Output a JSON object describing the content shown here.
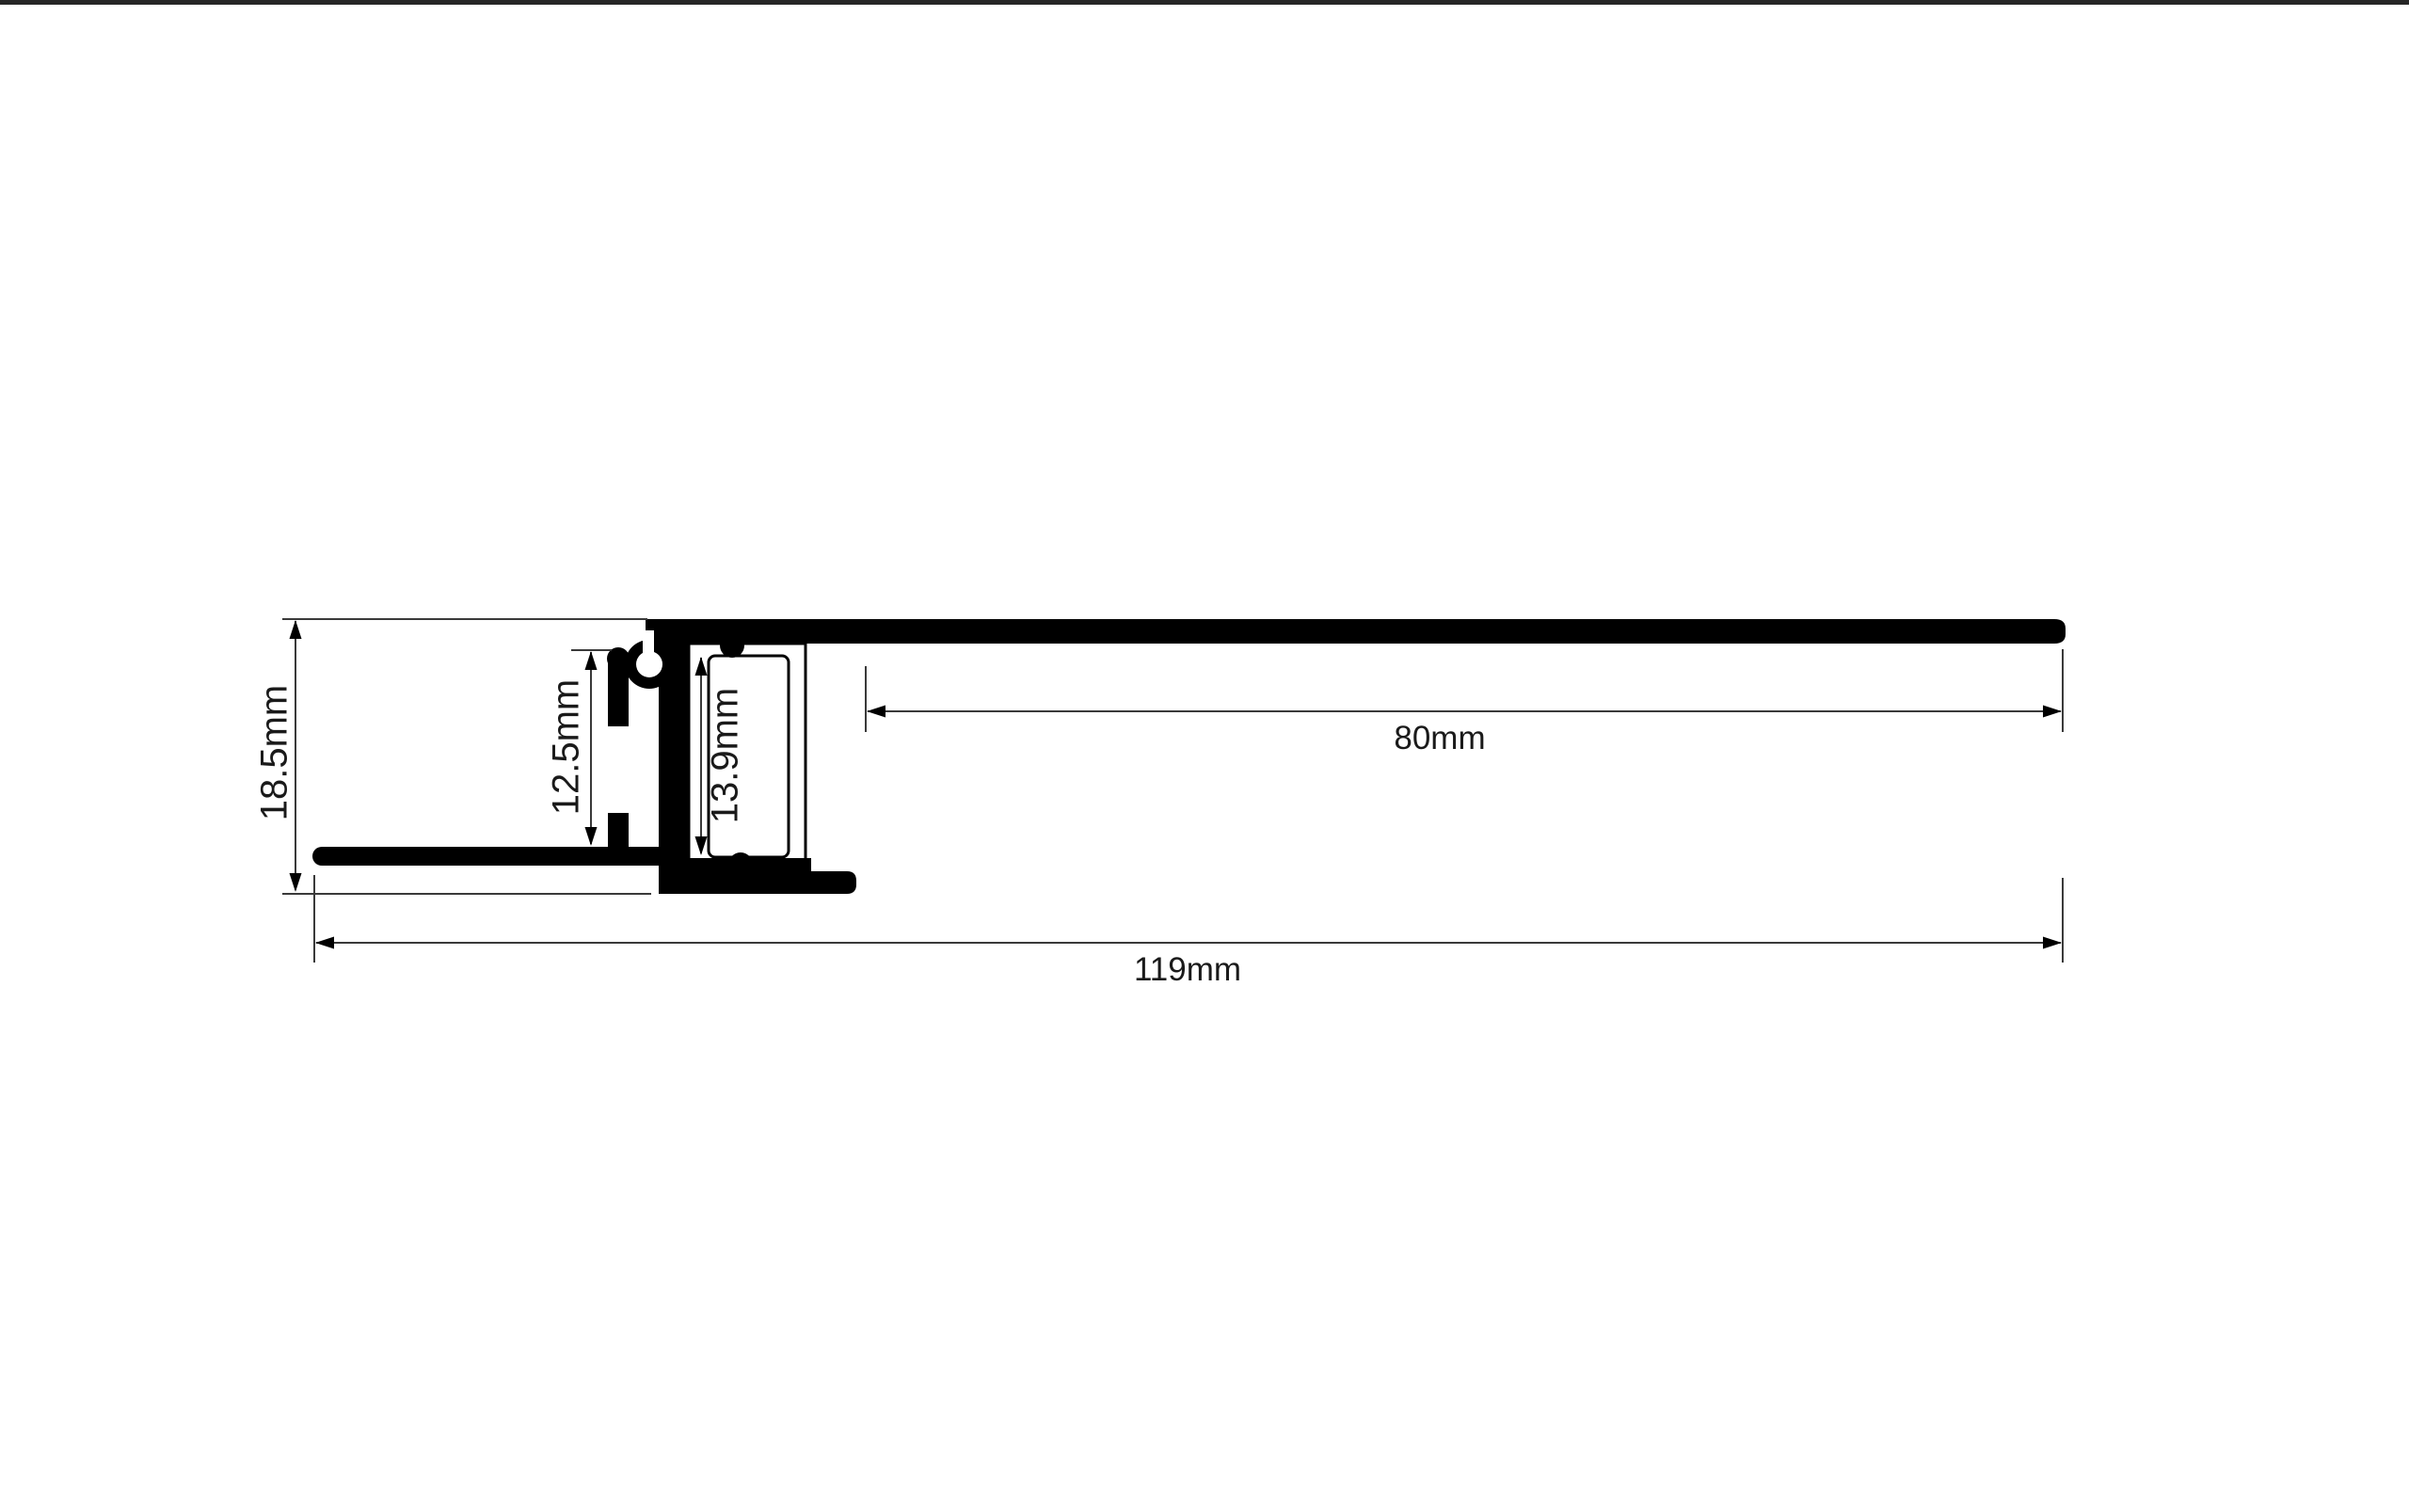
{
  "diagram": {
    "background_color": "#ffffff",
    "profile_color": "#000000",
    "dimension_line_color": "#3a3a3a",
    "dimension_labels": {
      "overall_height": "18.5mm",
      "recess_depth": "12.5mm",
      "diffuser_height": "13.9mm",
      "top_flange_length": "80mm",
      "overall_width": "119mm"
    }
  }
}
